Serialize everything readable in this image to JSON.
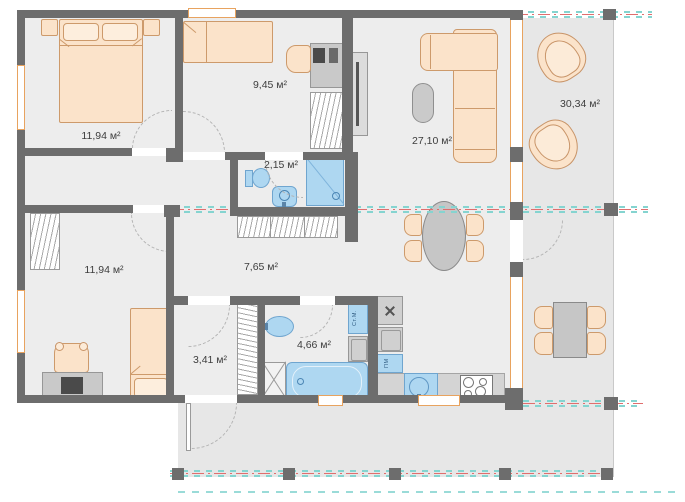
{
  "plan": {
    "rooms": [
      {
        "name": "bedroom-top",
        "area": "11,94 м²"
      },
      {
        "name": "kids-room",
        "area": "9,45 м²"
      },
      {
        "name": "shower-wc",
        "area": "2,15 м²"
      },
      {
        "name": "living-room",
        "area": "27,10 м²"
      },
      {
        "name": "terrace",
        "area": "30,34 м²"
      },
      {
        "name": "bedroom-bottom",
        "area": "11,94 м²"
      },
      {
        "name": "hallway",
        "area": "7,65 м²"
      },
      {
        "name": "entry",
        "area": "3,41 м²"
      },
      {
        "name": "bathroom",
        "area": "4,66 м²"
      }
    ],
    "appliances": {
      "washing_machine": "Ст.М.",
      "dishwasher": "ПМ"
    },
    "colors": {
      "wall": "#6d6d6d",
      "furniture": "#fbe3ca",
      "plumbing": "#aed7f1",
      "section_red": "#e06e6e",
      "section_teal": "#85d4d0",
      "window_frame": "#e8a35f"
    }
  }
}
